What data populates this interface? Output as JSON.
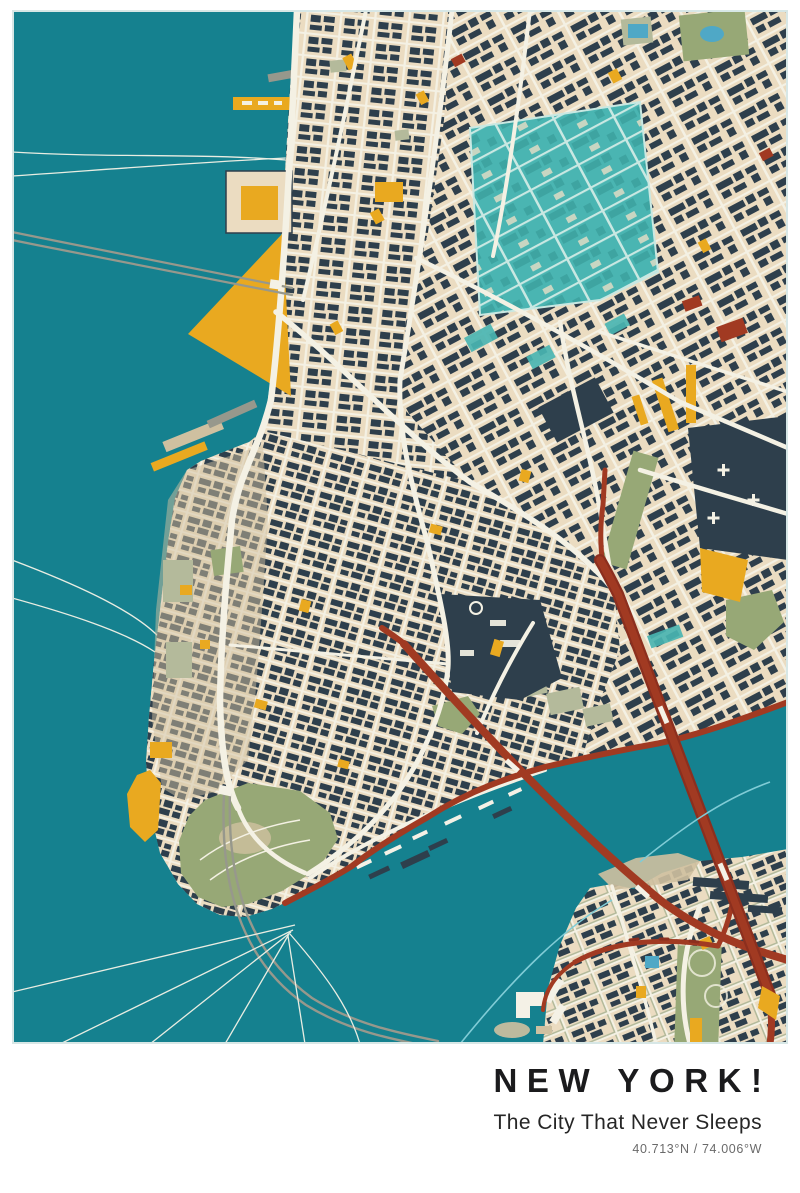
{
  "poster": {
    "title": "NEW YORK!",
    "subtitle": "The City That Never Sleeps",
    "coordinates": "40.713°N / 74.006°W"
  },
  "palette": {
    "water": "#15818F",
    "land": "#EBDCC1",
    "street": "#F4F1E4",
    "building": "#2E3F4C",
    "highlight": "#4AB5B2",
    "highlightStreet": "#C9E8E2",
    "highlightDeep": "#3EA4A1",
    "park": "#97A876",
    "parkLight": "#B4BA9B",
    "sand": "#CFC0A0",
    "accent": "#E9A920",
    "highway": "#A13A22",
    "highwayDark": "#8C2F1E",
    "tunnel": "#97988C",
    "ferry": "#E9EDE2",
    "ferryBlue": "#80CCD6",
    "pond": "#4FA8C6",
    "pier": "#F4F1E6",
    "ink": "#1B1B1D",
    "inkSoft": "#262626",
    "inkFaint": "#6A6A6A",
    "frameEdge": "#D7E7E6"
  }
}
